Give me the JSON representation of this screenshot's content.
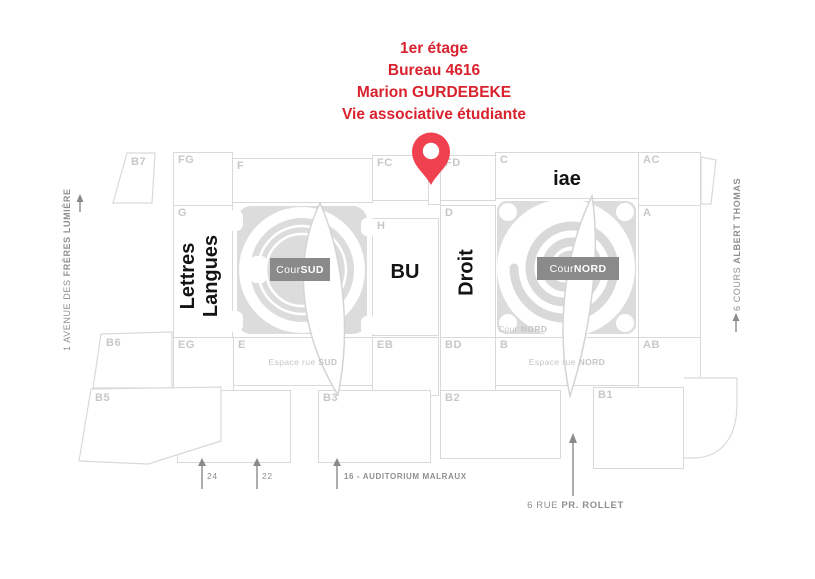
{
  "header": {
    "lines": [
      "1er étage",
      "Bureau 4616",
      "Marion GURDEBEKE",
      "Vie associative étudiante"
    ]
  },
  "map": {
    "blocks": {
      "b7": "B7",
      "fg": "FG",
      "f": "F",
      "fc": "FC",
      "fd": "FD",
      "c": "C",
      "ac": "AC",
      "g": "G",
      "h": "H",
      "d": "D",
      "a": "A",
      "b6": "B6",
      "eg": "EG",
      "e": "E",
      "eb": "EB",
      "bd": "BD",
      "b": "B",
      "ab": "AB",
      "b5": "B5",
      "b4": "B4",
      "b3": "B3",
      "b2": "B2",
      "b1": "B1"
    },
    "buildings": {
      "lettres": "Lettres",
      "langues": "Langues",
      "bu": "BU",
      "droit": "Droit",
      "iae": "iae"
    },
    "courtyards": {
      "sud_prefix": "Cour ",
      "sud_bold": "SUD",
      "nord_prefix": "Cour ",
      "nord_bold": "NORD",
      "nord_small_prefix": "Cour ",
      "nord_small_bold": "NORD"
    },
    "corridors": {
      "sud_prefix": "Espace rue ",
      "sud_bold": "SUD",
      "nord_prefix": "Espace rue ",
      "nord_bold": "NORD"
    }
  },
  "streets": {
    "left_prefix": "1 AVENUE DES ",
    "left_bold": "FRÈRES LUMIÈRE",
    "right_prefix": "6 COURS ",
    "right_bold": "ALBERT THOMAS",
    "bottom_prefix": "6 RUE ",
    "bottom_bold": "PR. ROLLET"
  },
  "entrances": {
    "e24": "24",
    "e22": "22",
    "e16": "16 - AUDITORIUM MALRAUX"
  },
  "colors": {
    "accent_red": "#d8232f",
    "pin_red": "#ef4150",
    "badge_gray": "#8a8a8a",
    "court_gray": "#dcdcdc",
    "outline_gray": "#d9d9d9",
    "label_gray": "#c6c9c8"
  }
}
